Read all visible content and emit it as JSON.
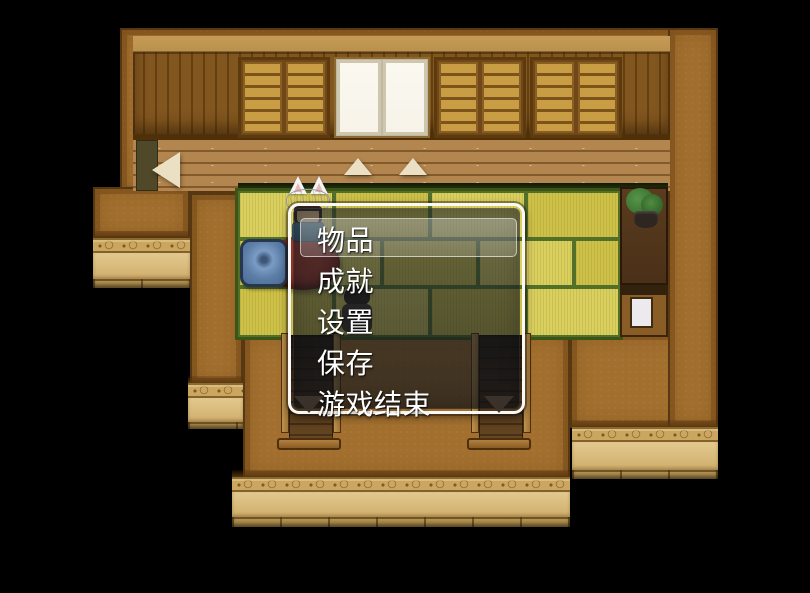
{
  "game": {
    "title": "rpg-maker-style-house-interior",
    "menu": {
      "items": [
        {
          "label": "物品",
          "selected": true
        },
        {
          "label": "成就",
          "selected": false
        },
        {
          "label": "设置",
          "selected": false
        },
        {
          "label": "保存",
          "selected": false
        },
        {
          "label": "游戏结束",
          "selected": false
        }
      ]
    },
    "map_indicators": {
      "left_arrow": "◀",
      "up_arrows": [
        "▲",
        "▲"
      ],
      "down_arrows": [
        "▼",
        "▼"
      ]
    }
  },
  "palette": {
    "background": "#000000",
    "roof_brown": "#a26f2e",
    "exterior_wall_tan": "#dcc084",
    "ornament_band": "#caa660",
    "tatami_yellow": "#d5c751",
    "tatami_green_line": "#53702a",
    "wood_floor": "#ad7d42",
    "wall_panel": "#7d531d",
    "cupboard_door": "#c89d44",
    "shoji_white": "#f7f3e9",
    "cushion_blue": "#5b7da6",
    "table_red": "#7c2017",
    "window_border": "#f8f8f6",
    "window_background": "rgba(24,30,40,0.62)",
    "selection_cursor": "rgba(255,255,255,0.25)",
    "menu_text": "#ffffff",
    "arrow_light": "#ece0c4",
    "arrow_dark": "#3b332b"
  }
}
